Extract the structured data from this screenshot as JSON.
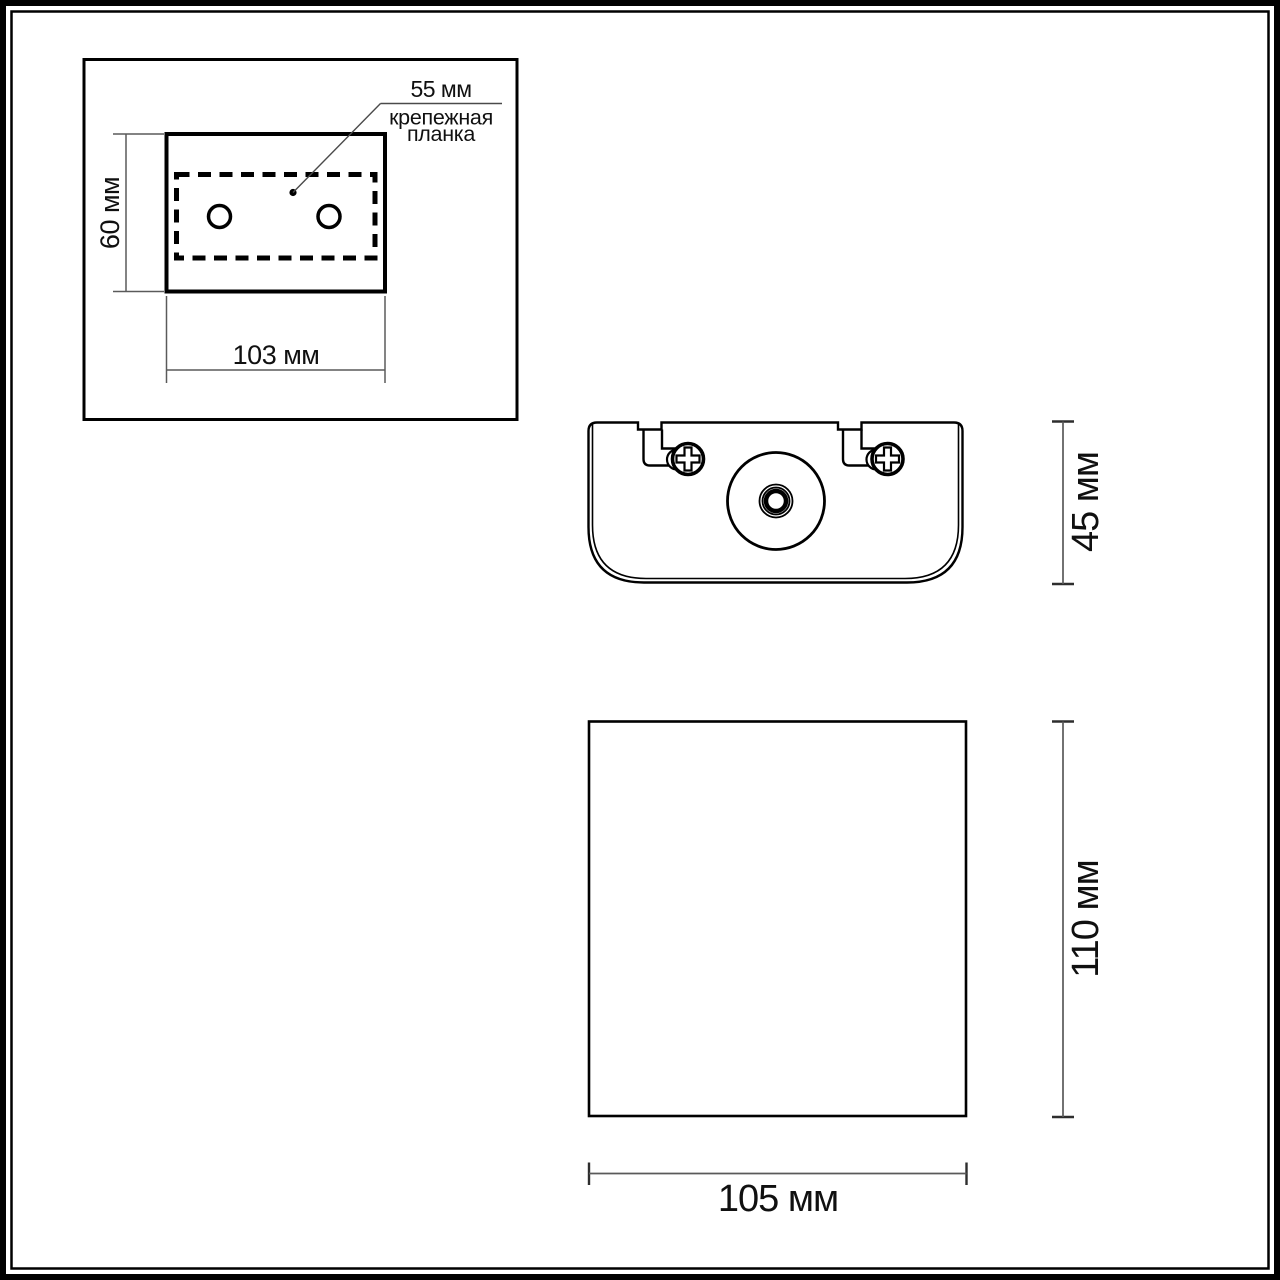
{
  "views": {
    "mounting_detail": {
      "height_label": "60 мм",
      "width_label": "103 мм",
      "plate_width_label": "55 мм",
      "callout_line1": "крепежная",
      "callout_line2": "планка"
    },
    "top_view": {
      "depth_label": "45 мм"
    },
    "front_view": {
      "height_label": "110 мм",
      "width_label": "105 мм"
    }
  },
  "colors": {
    "drawing_line": "#000000",
    "dimension_line": "#5a5a5a",
    "text": "#101010",
    "background": "#ffffff"
  }
}
